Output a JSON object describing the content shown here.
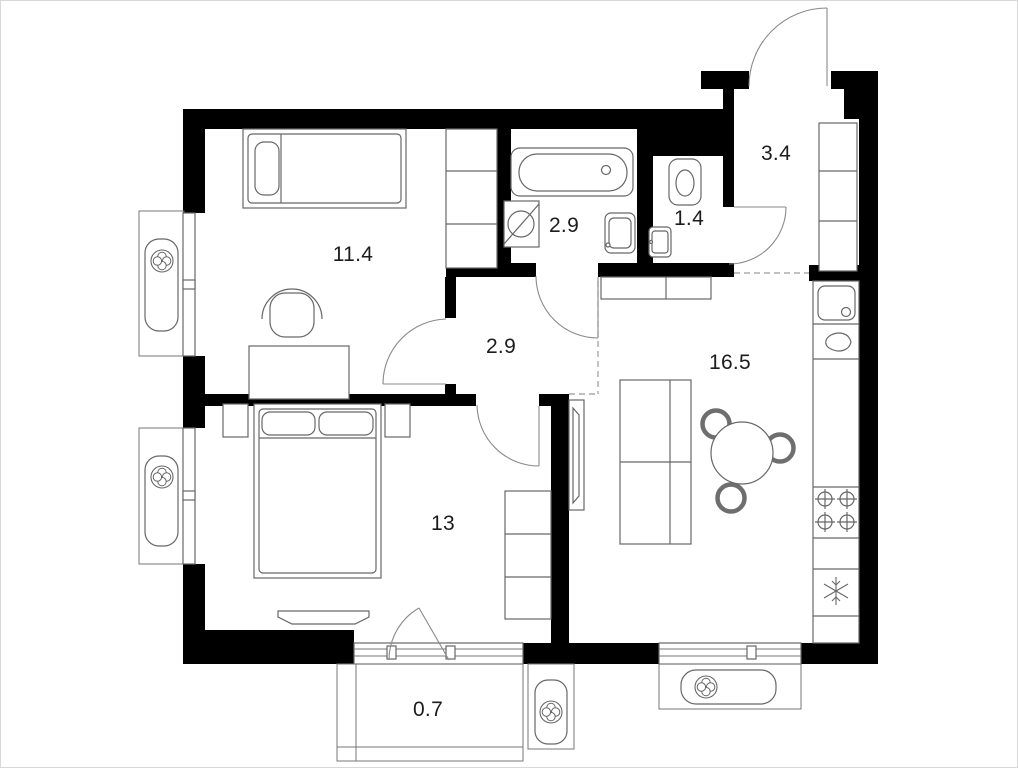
{
  "title": "Two-room apartment floor plan",
  "area_units": "m2",
  "rooms": [
    {
      "name": "bedroom-1",
      "area": "11.4"
    },
    {
      "name": "bathroom",
      "area": "2.9"
    },
    {
      "name": "wc",
      "area": "1.4"
    },
    {
      "name": "entrance-hall",
      "area": "3.4"
    },
    {
      "name": "corridor",
      "area": "2.9"
    },
    {
      "name": "kitchen-living-room",
      "area": "16.5"
    },
    {
      "name": "bedroom-2",
      "area": "13"
    },
    {
      "name": "balcony",
      "area": "0.7"
    }
  ],
  "icons": {
    "ac-fan": "four-petal fan in circle",
    "freezer": "snowflake",
    "stove": "four burners with cross",
    "washing-machine": "circle with diagonal line"
  },
  "colors": {
    "background": "#ffffff",
    "wall": "#000000",
    "furniture-line": "#676767",
    "dashed-line": "#9b9b9b",
    "label-text": "#1c1c1c"
  }
}
